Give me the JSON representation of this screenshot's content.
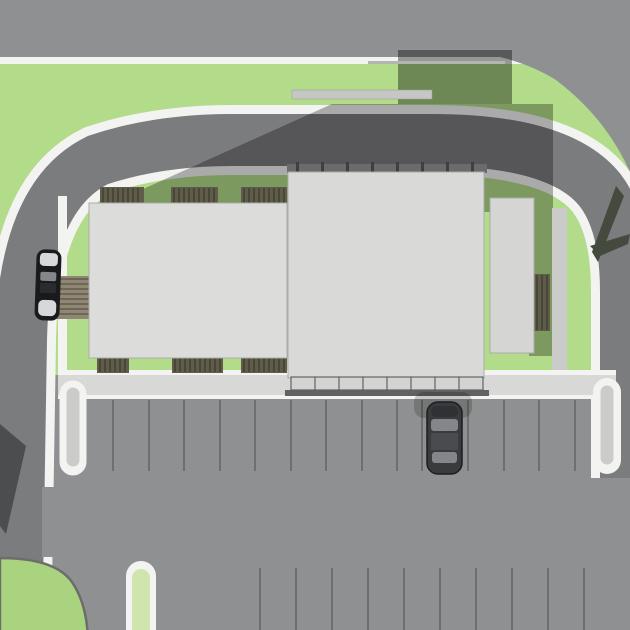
{
  "meta": {
    "title": "Architectural site plan - aerial top-down 3D rendering",
    "view": "plan view of commercial site with ring access road, three buildings, landscaping and parking lot"
  },
  "colors": {
    "base": "#8f9091",
    "road_ring": "#7b7c7e",
    "curb_white": "#f3f4f2",
    "green": "#b2db8a",
    "green_island": "#a9d37f",
    "green_capsule": "#cfe5ad",
    "shadow": "rgba(0,0,0,0.30)",
    "shadow_deep": "rgba(0,0,0,0.38)",
    "sidewalk": "#d8d9d7",
    "sidewalk_mid": "#cbccca",
    "building_left": "#dcddda",
    "building_center": "#d9dad7",
    "building_right": "#d5d6d3",
    "building_edge": "#abaca9",
    "roof_band": "#6a6b6d",
    "roof_tick": "#3e3f41",
    "canopy_cell": "#d3d4d2",
    "canopy_edge": "#4b4c4e",
    "canopy_shadow": "#606163",
    "hedge": "#5f5c49",
    "hedge_stripe": "#49473a",
    "mat": "#8f8673",
    "mat_stripe": "#6e6654",
    "stall_line": "#6e6f70",
    "island_edge": "#6d6e6c",
    "tree": "#454a3f",
    "car_body": "#3a3b3e",
    "car_outline": "#1c1d1f",
    "car_glass": "#85868a",
    "car_roof": "#4a4b4f",
    "car_black": "#191a1c",
    "car_highlight": "#d7d8da",
    "walkway_bar": "#c6c7c5",
    "car_shadow": "rgba(0,0,0,0.18)"
  },
  "scene": {
    "parking": {
      "rows": [
        {
          "y1": 400,
          "y2": 471,
          "xs": [
            113,
            149,
            184,
            220,
            255,
            291,
            326,
            362,
            397,
            422,
            468,
            504,
            539,
            575
          ]
        },
        {
          "y1": 568,
          "y2": 632,
          "xs": [
            260,
            296,
            332,
            368,
            404,
            440,
            476,
            512,
            548,
            584
          ]
        }
      ]
    },
    "hedges": [
      {
        "x": 100,
        "y": 187,
        "w": 44,
        "h": 17
      },
      {
        "x": 171,
        "y": 187,
        "w": 47,
        "h": 17
      },
      {
        "x": 241,
        "y": 187,
        "w": 46,
        "h": 17
      },
      {
        "x": 97,
        "y": 355,
        "w": 32,
        "h": 18
      },
      {
        "x": 172,
        "y": 355,
        "w": 51,
        "h": 18
      },
      {
        "x": 241,
        "y": 355,
        "w": 46,
        "h": 18
      },
      {
        "x": 529,
        "y": 274,
        "w": 21,
        "h": 57
      }
    ],
    "mats": [
      {
        "x": 54,
        "y": 276,
        "w": 37,
        "h": 43
      }
    ],
    "roof_ticks": {
      "y": 162,
      "w": 3,
      "h": 11,
      "xs": [
        296,
        321,
        346,
        371,
        396,
        421,
        446,
        471
      ]
    },
    "canopy": {
      "x": 291,
      "y": 377,
      "cell_w": 24,
      "cell_h": 13,
      "count": 8
    },
    "buildings": [
      {
        "name": "left-building"
      },
      {
        "name": "center-building"
      },
      {
        "name": "right-building"
      }
    ],
    "cars": [
      {
        "name": "drive-up-car"
      },
      {
        "name": "parked-car"
      }
    ],
    "tree": {
      "name": "plan-tree-symbol"
    }
  }
}
